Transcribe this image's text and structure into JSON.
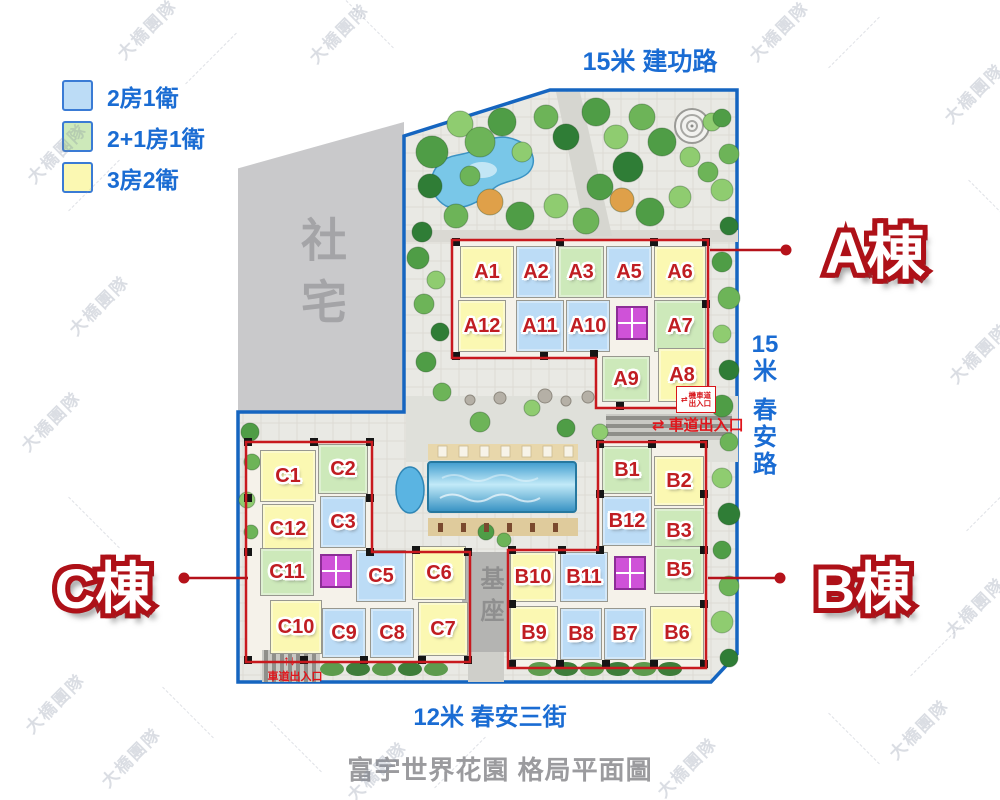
{
  "page_title": "富宇世界花園 格局平面圖",
  "watermark_text": "大橋團隊",
  "legend": {
    "items": [
      {
        "type": "2b1b",
        "label": "2房1衛",
        "color": "#bcdcf6"
      },
      {
        "type": "2p1b1b",
        "label": "2+1房1衛",
        "color": "#cde9ba"
      },
      {
        "type": "3b2b",
        "label": "3房2衛",
        "color": "#fbf8b2"
      }
    ]
  },
  "streets": {
    "top": "15米 建功路",
    "right": "15米 春安路",
    "right_chars": [
      "15",
      "米",
      "春",
      "安",
      "路"
    ],
    "bottom": "12米 春安三街"
  },
  "areas": {
    "social_housing": "社宅",
    "podium": "基座"
  },
  "entrances": {
    "vehicle": "車道出入口",
    "motorcycle_line1": "機車道",
    "motorcycle_line2": "出入口",
    "arrow_horizontal": "⇄",
    "arrow_vertical": "↑↓"
  },
  "buildings": [
    {
      "id": "A",
      "label": "A棟",
      "units": [
        {
          "id": "A1",
          "type": "3b2b"
        },
        {
          "id": "A2",
          "type": "2b1b"
        },
        {
          "id": "A3",
          "type": "2p1b1b"
        },
        {
          "id": "A5",
          "type": "2b1b"
        },
        {
          "id": "A6",
          "type": "3b2b"
        },
        {
          "id": "A12",
          "type": "3b2b"
        },
        {
          "id": "A11",
          "type": "2b1b"
        },
        {
          "id": "A10",
          "type": "2b1b"
        },
        {
          "id": "A7",
          "type": "2p1b1b"
        },
        {
          "id": "A9",
          "type": "2p1b1b"
        },
        {
          "id": "A8",
          "type": "3b2b"
        }
      ]
    },
    {
      "id": "B",
      "label": "B棟",
      "units": [
        {
          "id": "B1",
          "type": "2p1b1b"
        },
        {
          "id": "B2",
          "type": "3b2b"
        },
        {
          "id": "B12",
          "type": "2b1b"
        },
        {
          "id": "B3",
          "type": "2p1b1b"
        },
        {
          "id": "B10",
          "type": "3b2b"
        },
        {
          "id": "B11",
          "type": "2b1b"
        },
        {
          "id": "B5",
          "type": "2p1b1b"
        },
        {
          "id": "B9",
          "type": "3b2b"
        },
        {
          "id": "B8",
          "type": "2b1b"
        },
        {
          "id": "B7",
          "type": "2b1b"
        },
        {
          "id": "B6",
          "type": "3b2b"
        }
      ]
    },
    {
      "id": "C",
      "label": "C棟",
      "units": [
        {
          "id": "C1",
          "type": "3b2b"
        },
        {
          "id": "C2",
          "type": "2p1b1b"
        },
        {
          "id": "C12",
          "type": "3b2b"
        },
        {
          "id": "C3",
          "type": "2b1b"
        },
        {
          "id": "C11",
          "type": "2p1b1b"
        },
        {
          "id": "C5",
          "type": "2b1b"
        },
        {
          "id": "C6",
          "type": "3b2b"
        },
        {
          "id": "C10",
          "type": "3b2b"
        },
        {
          "id": "C9",
          "type": "2b1b"
        },
        {
          "id": "C8",
          "type": "2b1b"
        },
        {
          "id": "C7",
          "type": "3b2b"
        }
      ]
    }
  ],
  "colors": {
    "street_text": "#1a6cd3",
    "unit_label": "#c01d22",
    "building_outline": "#c8191e",
    "building_label_outline": "#ae1118",
    "site_boundary": "#1565c0",
    "elevator_core": "#cf52d8",
    "title_text": "#9b9b9e"
  }
}
